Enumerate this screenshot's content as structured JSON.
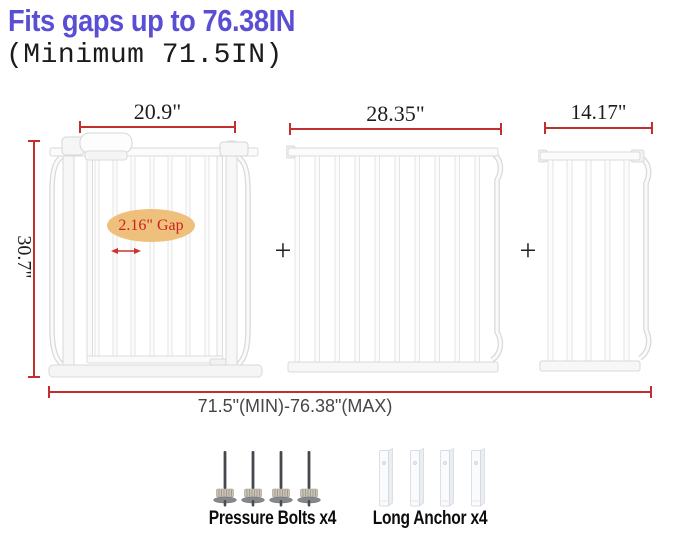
{
  "page": {
    "title": "Fits gaps up to 76.38IN",
    "subtitle": "(Minimum 71.5IN)",
    "title_color": "#5a4fd4"
  },
  "diagram": {
    "height_label": "30.7\"",
    "total_label": "71.5\"(MIN)-76.38\"(MAX)",
    "plus": "+",
    "gap_callout": "2.16\" Gap",
    "panels": [
      {
        "id": "walk-through-gate",
        "width_label": "20.9\"",
        "bars": 7
      },
      {
        "id": "extension-panel-wide",
        "width_label": "28.35\"",
        "bars": 10
      },
      {
        "id": "extension-panel-narrow",
        "width_label": "14.17\"",
        "bars": 5
      }
    ],
    "colors": {
      "dimension_line": "#c12f2f",
      "gap_ellipse_fill": "#eec07b",
      "gap_text": "#ce2020"
    }
  },
  "hardware": [
    {
      "icon": "pressure-bolt-icon",
      "label": "Pressure Bolts x4",
      "count": 4
    },
    {
      "icon": "long-anchor-icon",
      "label": "Long Anchor x4",
      "count": 4
    }
  ]
}
